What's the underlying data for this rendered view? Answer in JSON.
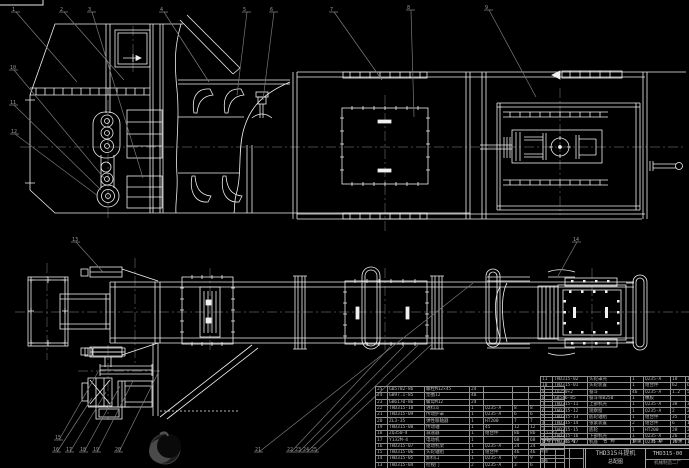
{
  "colors": {
    "background": "#000000",
    "line": "#f0f0f0",
    "leader": "#7a7a7a",
    "centerline": "#5e5e5e",
    "table_text": "#b8b8b8"
  },
  "title_block": {
    "product": "THD315斗提机",
    "sheet": "总配图",
    "number": "THD315-00",
    "company": "机械制造二厂",
    "cells": [
      "制图",
      "审核"
    ]
  },
  "bom": {
    "headers": [
      "序号",
      "代 号",
      "名 称",
      "数量",
      "材 料",
      "单重",
      "总重",
      "备注"
    ],
    "left_rows": [
      [
        "25",
        "GB5782-86",
        "螺栓M12×45",
        "24",
        "",
        "",
        "",
        ""
      ],
      [
        "24",
        "GB97.1-85",
        "垫圈12",
        "48",
        "",
        "",
        "",
        ""
      ],
      [
        "23",
        "GB6170-86",
        "螺母M12",
        "24",
        "",
        "",
        "",
        ""
      ],
      [
        "22",
        "THD315-10",
        "进料斗",
        "1",
        "Q235-A",
        "8",
        "8",
        ""
      ],
      [
        "21",
        "THD315-09",
        "传动护罩",
        "1",
        "Q235-A",
        "6",
        "6",
        ""
      ],
      [
        "20",
        "ZL3-35",
        "弹性联轴器",
        "1",
        "HT200",
        "7",
        "7",
        ""
      ],
      [
        "19",
        "THD315-08",
        "传动轴",
        "1",
        "45",
        "12",
        "12",
        ""
      ],
      [
        "18",
        "ZQ350-Ⅱ",
        "减速器",
        "1",
        "组合件",
        "86",
        "86",
        "i=23.34"
      ],
      [
        "17",
        "Y132M-4",
        "电动机",
        "1",
        "",
        "68",
        "68",
        "7.5kW"
      ],
      [
        "16",
        "THD315-07",
        "驱动机架",
        "1",
        "Q235-A",
        "24",
        "24",
        ""
      ],
      [
        "15",
        "THD315-06",
        "头轮轴组",
        "1",
        "组合件",
        "46",
        "46",
        ""
      ],
      [
        "14",
        "THD315-05",
        "卸料口",
        "1",
        "Q235-A",
        "9",
        "9",
        ""
      ],
      [
        "13",
        "THD315-04",
        "检视门",
        "2",
        "Q235-A",
        "3",
        "6",
        ""
      ],
      [
        "12",
        "THD315-03",
        "中部机壳",
        "4",
        "Q235-A",
        "22",
        "88",
        ""
      ]
    ],
    "right_rows": [
      [
        "11",
        "THD315-02",
        "头轮罩壳",
        "1",
        "Q235-A",
        "18",
        "18",
        ""
      ],
      [
        "10",
        "THD315-01",
        "头轮装置",
        "1",
        "组合件",
        "62",
        "62",
        ""
      ],
      [
        "9",
        "TD250×2",
        "畚斗",
        "46",
        "Q235-A",
        "1.2",
        "55",
        ""
      ],
      [
        "8",
        "GB546-85",
        "畚斗带B250",
        "1",
        "橡胶",
        "",
        "",
        "L=14.5m"
      ],
      [
        "7",
        "THD315-11",
        "上部机壳",
        "1",
        "Q235-A",
        "38",
        "38",
        ""
      ],
      [
        "6",
        "THD315-12",
        "观察窗",
        "1",
        "Q235-A",
        "2",
        "2",
        ""
      ],
      [
        "5",
        "THD315-13",
        "底轮轴组",
        "1",
        "组合件",
        "35",
        "35",
        ""
      ],
      [
        "4",
        "THD315-14",
        "张紧装置",
        "2",
        "组合件",
        "6",
        "12",
        ""
      ],
      [
        "3",
        "THD315-15",
        "底轮",
        "1",
        "HT200",
        "28",
        "28",
        ""
      ],
      [
        "2",
        "THD315-16",
        "下部机壳",
        "1",
        "Q235-A",
        "26",
        "26",
        ""
      ],
      [
        "1",
        "THD315-17",
        "机座",
        "1",
        "Q235-A",
        "15",
        "15",
        ""
      ]
    ]
  },
  "balloons": [
    {
      "label": "1",
      "x": 12,
      "y": 10,
      "tx": 77,
      "ty": 82
    },
    {
      "label": "2",
      "x": 60,
      "y": 10,
      "tx": 124,
      "ty": 80
    },
    {
      "label": "3",
      "x": 88,
      "y": 10,
      "tx": 143,
      "ty": 178
    },
    {
      "label": "4",
      "x": 160,
      "y": 10,
      "tx": 209,
      "ty": 82
    },
    {
      "label": "5",
      "x": 243,
      "y": 10,
      "tx": 237,
      "ty": 95
    },
    {
      "label": "6",
      "x": 270,
      "y": 10,
      "tx": 263,
      "ty": 100
    },
    {
      "label": "7",
      "x": 330,
      "y": 10,
      "tx": 382,
      "ty": 80
    },
    {
      "label": "8",
      "x": 407,
      "y": 8,
      "tx": 414,
      "ty": 117
    },
    {
      "label": "9",
      "x": 485,
      "y": 8,
      "tx": 536,
      "ty": 97
    },
    {
      "label": "10",
      "x": 10,
      "y": 68,
      "tx": 104,
      "ty": 178
    },
    {
      "label": "11",
      "x": 10,
      "y": 103,
      "tx": 101,
      "ty": 190
    },
    {
      "label": "12",
      "x": 11,
      "y": 132,
      "tx": 98,
      "ty": 196
    },
    {
      "label": "13",
      "x": 72,
      "y": 240,
      "tx": 103,
      "ty": 272
    },
    {
      "label": "14",
      "x": 573,
      "y": 240,
      "tx": 558,
      "ty": 276
    },
    {
      "label": "15",
      "x": 55,
      "y": 438,
      "tx": 98,
      "ty": 372
    },
    {
      "label": "16",
      "x": 53,
      "y": 450,
      "tx": 92,
      "ty": 398
    },
    {
      "label": "17",
      "x": 66,
      "y": 450,
      "tx": 106,
      "ty": 392
    },
    {
      "label": "18",
      "x": 80,
      "y": 450,
      "tx": 120,
      "ty": 386
    },
    {
      "label": "19",
      "x": 93,
      "y": 450,
      "tx": 133,
      "ty": 381
    },
    {
      "label": "20",
      "x": 115,
      "y": 450,
      "tx": 158,
      "ty": 373
    },
    {
      "label": "21",
      "x": 255,
      "y": 450,
      "tx": 473,
      "ty": 283
    },
    {
      "label": "22",
      "x": 287,
      "y": 450,
      "tx": 390,
      "ty": 347
    },
    {
      "label": "23",
      "x": 295,
      "y": 450,
      "tx": 404,
      "ty": 346
    },
    {
      "label": "24",
      "x": 303,
      "y": 450,
      "tx": 418,
      "ty": 345
    },
    {
      "label": "25",
      "x": 311,
      "y": 450,
      "tx": 432,
      "ty": 344
    }
  ]
}
